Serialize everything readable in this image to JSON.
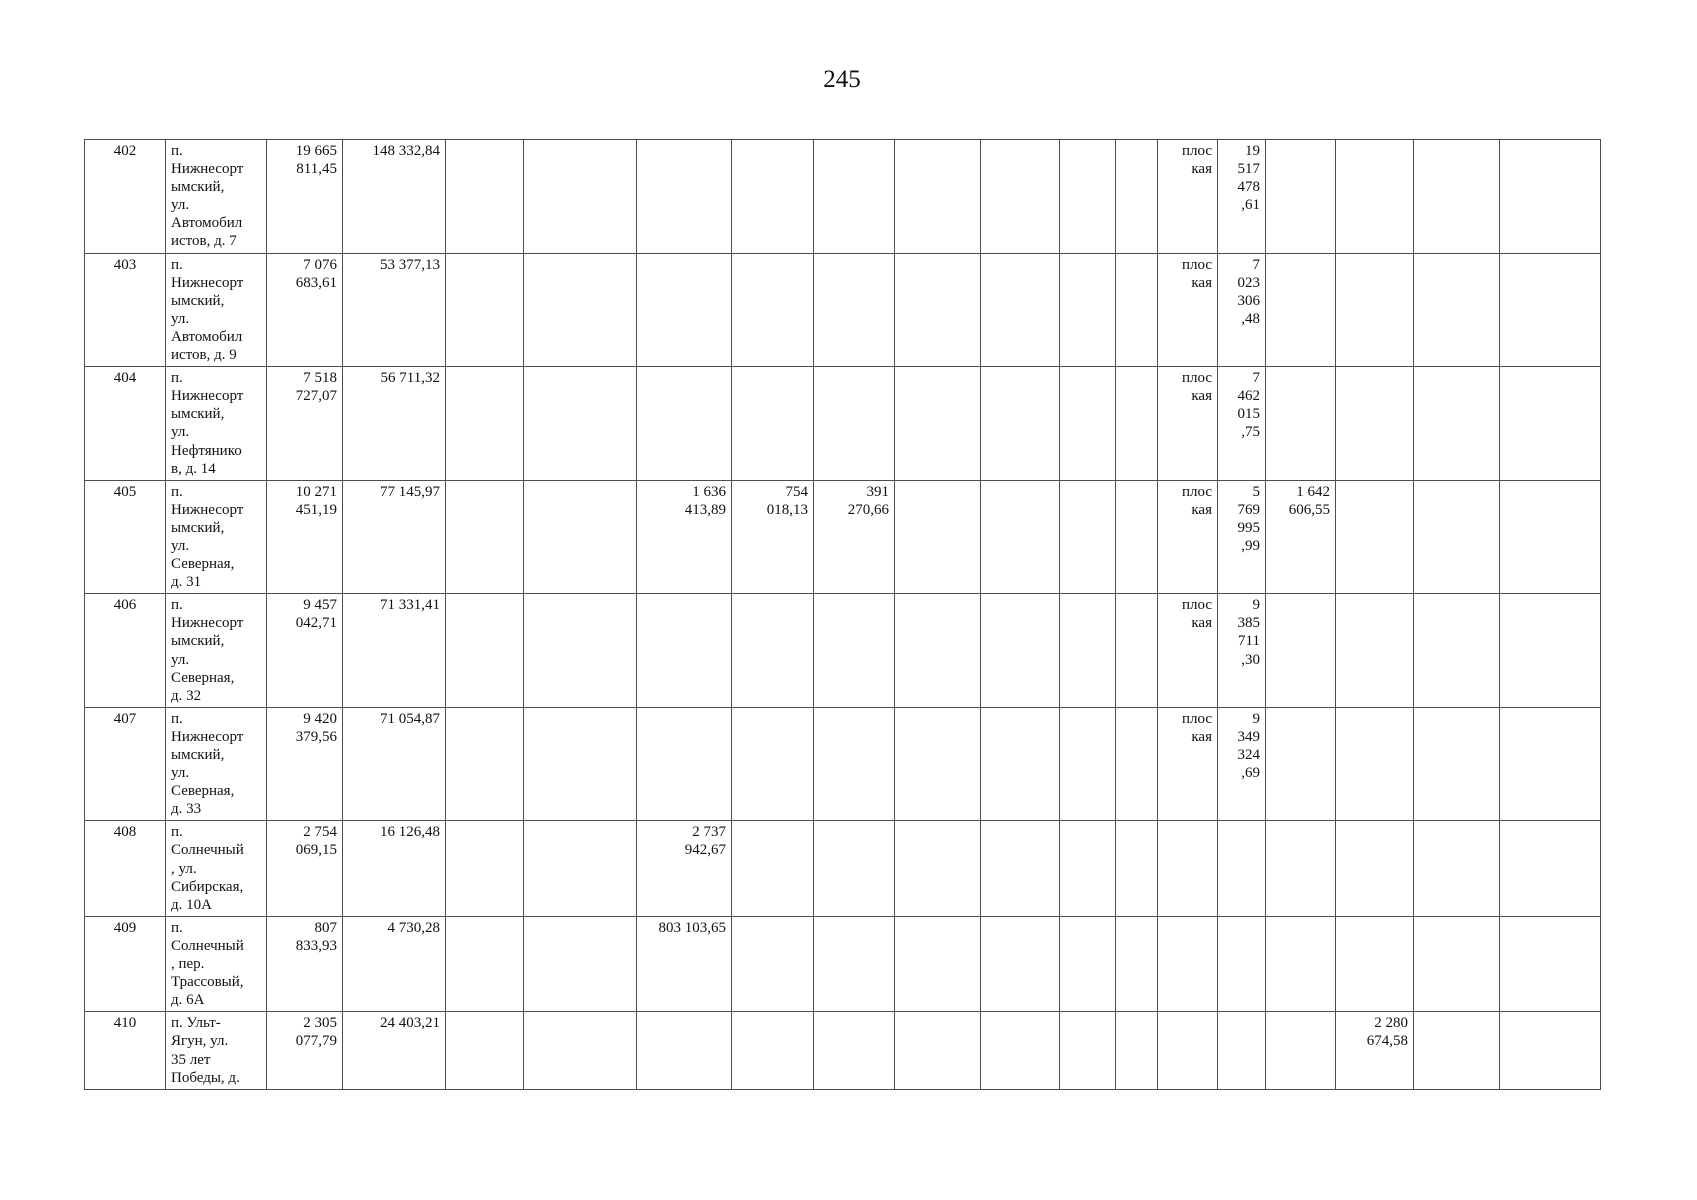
{
  "page": {
    "number": "245"
  },
  "table": {
    "columns": [
      {
        "key": "row-number",
        "width": 81
      },
      {
        "key": "address",
        "width": 101
      },
      {
        "key": "amount-1",
        "width": 76
      },
      {
        "key": "amount-2",
        "width": 103
      },
      {
        "key": "col-5",
        "width": 78
      },
      {
        "key": "col-6",
        "width": 113
      },
      {
        "key": "amount-3",
        "width": 95
      },
      {
        "key": "amount-4",
        "width": 82
      },
      {
        "key": "amount-5",
        "width": 81
      },
      {
        "key": "col-10",
        "width": 86
      },
      {
        "key": "col-11",
        "width": 79
      },
      {
        "key": "col-12",
        "width": 56
      },
      {
        "key": "col-13",
        "width": 42
      },
      {
        "key": "roof-type",
        "width": 60
      },
      {
        "key": "roof-amount",
        "width": 48
      },
      {
        "key": "amount-6",
        "width": 70
      },
      {
        "key": "amount-7",
        "width": 78
      },
      {
        "key": "col-18",
        "width": 86
      },
      {
        "key": "col-19",
        "width": 101
      }
    ],
    "rows": [
      {
        "cells": [
          "402",
          "п.\nНижнесорт\nымский,\nул.\nАвтомобил\nистов, д. 7",
          "19 665\n811,45",
          "148 332,84",
          "",
          "",
          "",
          "",
          "",
          "",
          "",
          "",
          "",
          "плос\nкая",
          "19\n517\n478\n,61",
          "",
          "",
          "",
          ""
        ]
      },
      {
        "cells": [
          "403",
          "п.\nНижнесорт\nымский,\nул.\nАвтомобил\nистов, д. 9",
          "7 076\n683,61",
          "53 377,13",
          "",
          "",
          "",
          "",
          "",
          "",
          "",
          "",
          "",
          "плос\nкая",
          "7\n023\n306\n,48",
          "",
          "",
          "",
          ""
        ]
      },
      {
        "cells": [
          "404",
          "п.\nНижнесорт\nымский,\nул.\nНефтянико\nв, д. 14",
          "7 518\n727,07",
          "56 711,32",
          "",
          "",
          "",
          "",
          "",
          "",
          "",
          "",
          "",
          "плос\nкая",
          "7\n462\n015\n,75",
          "",
          "",
          "",
          ""
        ]
      },
      {
        "cells": [
          "405",
          "п.\nНижнесорт\nымский,\nул.\nСеверная,\nд. 31",
          "10 271\n451,19",
          "77 145,97",
          "",
          "",
          "1 636\n413,89",
          "754\n018,13",
          "391\n270,66",
          "",
          "",
          "",
          "",
          "плос\nкая",
          "5\n769\n995\n,99",
          "1 642\n606,55",
          "",
          "",
          ""
        ]
      },
      {
        "cells": [
          "406",
          "п.\nНижнесорт\nымский,\nул.\nСеверная,\nд. 32",
          "9 457\n042,71",
          "71 331,41",
          "",
          "",
          "",
          "",
          "",
          "",
          "",
          "",
          "",
          "плос\nкая",
          "9\n385\n711\n,30",
          "",
          "",
          "",
          ""
        ]
      },
      {
        "cells": [
          "407",
          "п.\nНижнесорт\nымский,\nул.\nСеверная,\nд. 33",
          "9 420\n379,56",
          "71 054,87",
          "",
          "",
          "",
          "",
          "",
          "",
          "",
          "",
          "",
          "плос\nкая",
          "9\n349\n324\n,69",
          "",
          "",
          "",
          ""
        ]
      },
      {
        "cells": [
          "408",
          "п.\nСолнечный\n, ул.\nСибирская,\nд. 10А",
          "2 754\n069,15",
          "16 126,48",
          "",
          "",
          "2 737\n942,67",
          "",
          "",
          "",
          "",
          "",
          "",
          "",
          "",
          "",
          "",
          "",
          ""
        ]
      },
      {
        "cells": [
          "409",
          "п.\nСолнечный\n, пер.\nТрассовый,\nд. 6А",
          "807\n833,93",
          "4 730,28",
          "",
          "",
          "803 103,65",
          "",
          "",
          "",
          "",
          "",
          "",
          "",
          "",
          "",
          "",
          "",
          ""
        ]
      },
      {
        "cells": [
          "410",
          "п. Ульт-\nЯгун, ул.\n35 лет\nПобеды, д.",
          "2 305\n077,79",
          "24 403,21",
          "",
          "",
          "",
          "",
          "",
          "",
          "",
          "",
          "",
          "",
          "",
          "",
          "2 280\n674,58",
          "",
          ""
        ]
      }
    ]
  }
}
